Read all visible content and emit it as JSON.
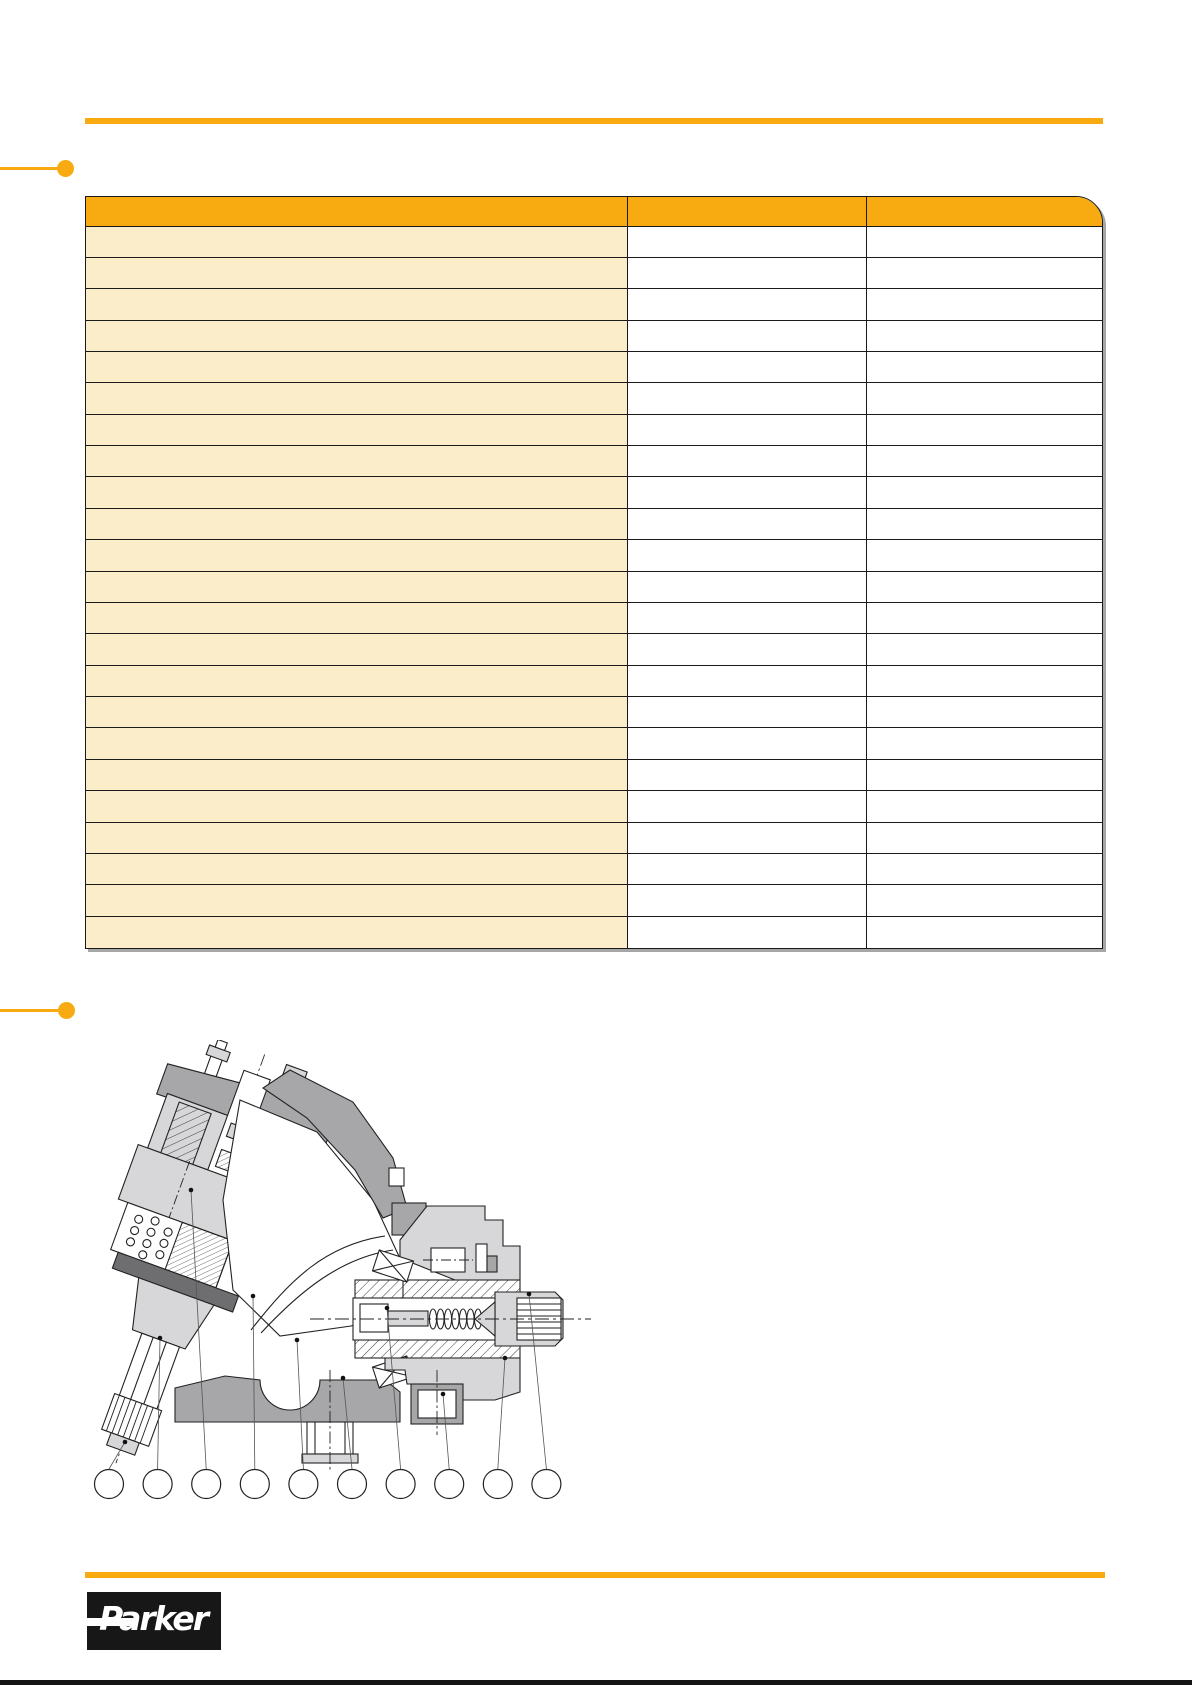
{
  "page": {
    "background": "#ffffff"
  },
  "theme": {
    "accent_orange": "#F8AB10",
    "row_cream": "#FBEDC9",
    "table_border": "#1a1a1a",
    "table_shadow": "#a6a6a6",
    "drawing_light_gray": "#d7d7d9",
    "drawing_mid_gray": "#a7a7a9",
    "drawing_dark_gray": "#6e6e70",
    "bottom_rule_color": "#141414"
  },
  "table": {
    "header_cells": [
      "",
      "",
      ""
    ],
    "rows": [
      [
        "",
        "",
        ""
      ],
      [
        "",
        "",
        ""
      ],
      [
        "",
        "",
        ""
      ],
      [
        "",
        "",
        ""
      ],
      [
        "",
        "",
        ""
      ],
      [
        "",
        "",
        ""
      ],
      [
        "",
        "",
        ""
      ],
      [
        "",
        "",
        ""
      ],
      [
        "",
        "",
        ""
      ],
      [
        "",
        "",
        ""
      ],
      [
        "",
        "",
        ""
      ],
      [
        "",
        "",
        ""
      ],
      [
        "",
        "",
        ""
      ],
      [
        "",
        "",
        ""
      ],
      [
        "",
        "",
        ""
      ],
      [
        "",
        "",
        ""
      ],
      [
        "",
        "",
        ""
      ],
      [
        "",
        "",
        ""
      ],
      [
        "",
        "",
        ""
      ],
      [
        "",
        "",
        ""
      ],
      [
        "",
        "",
        ""
      ],
      [
        "",
        "",
        ""
      ],
      [
        "",
        "",
        ""
      ]
    ]
  },
  "drawing": {
    "callouts": [
      "",
      "",
      "",
      "",
      "",
      "",
      "",
      "",
      "",
      ""
    ]
  },
  "footer": {
    "logo_text": "Parker"
  }
}
